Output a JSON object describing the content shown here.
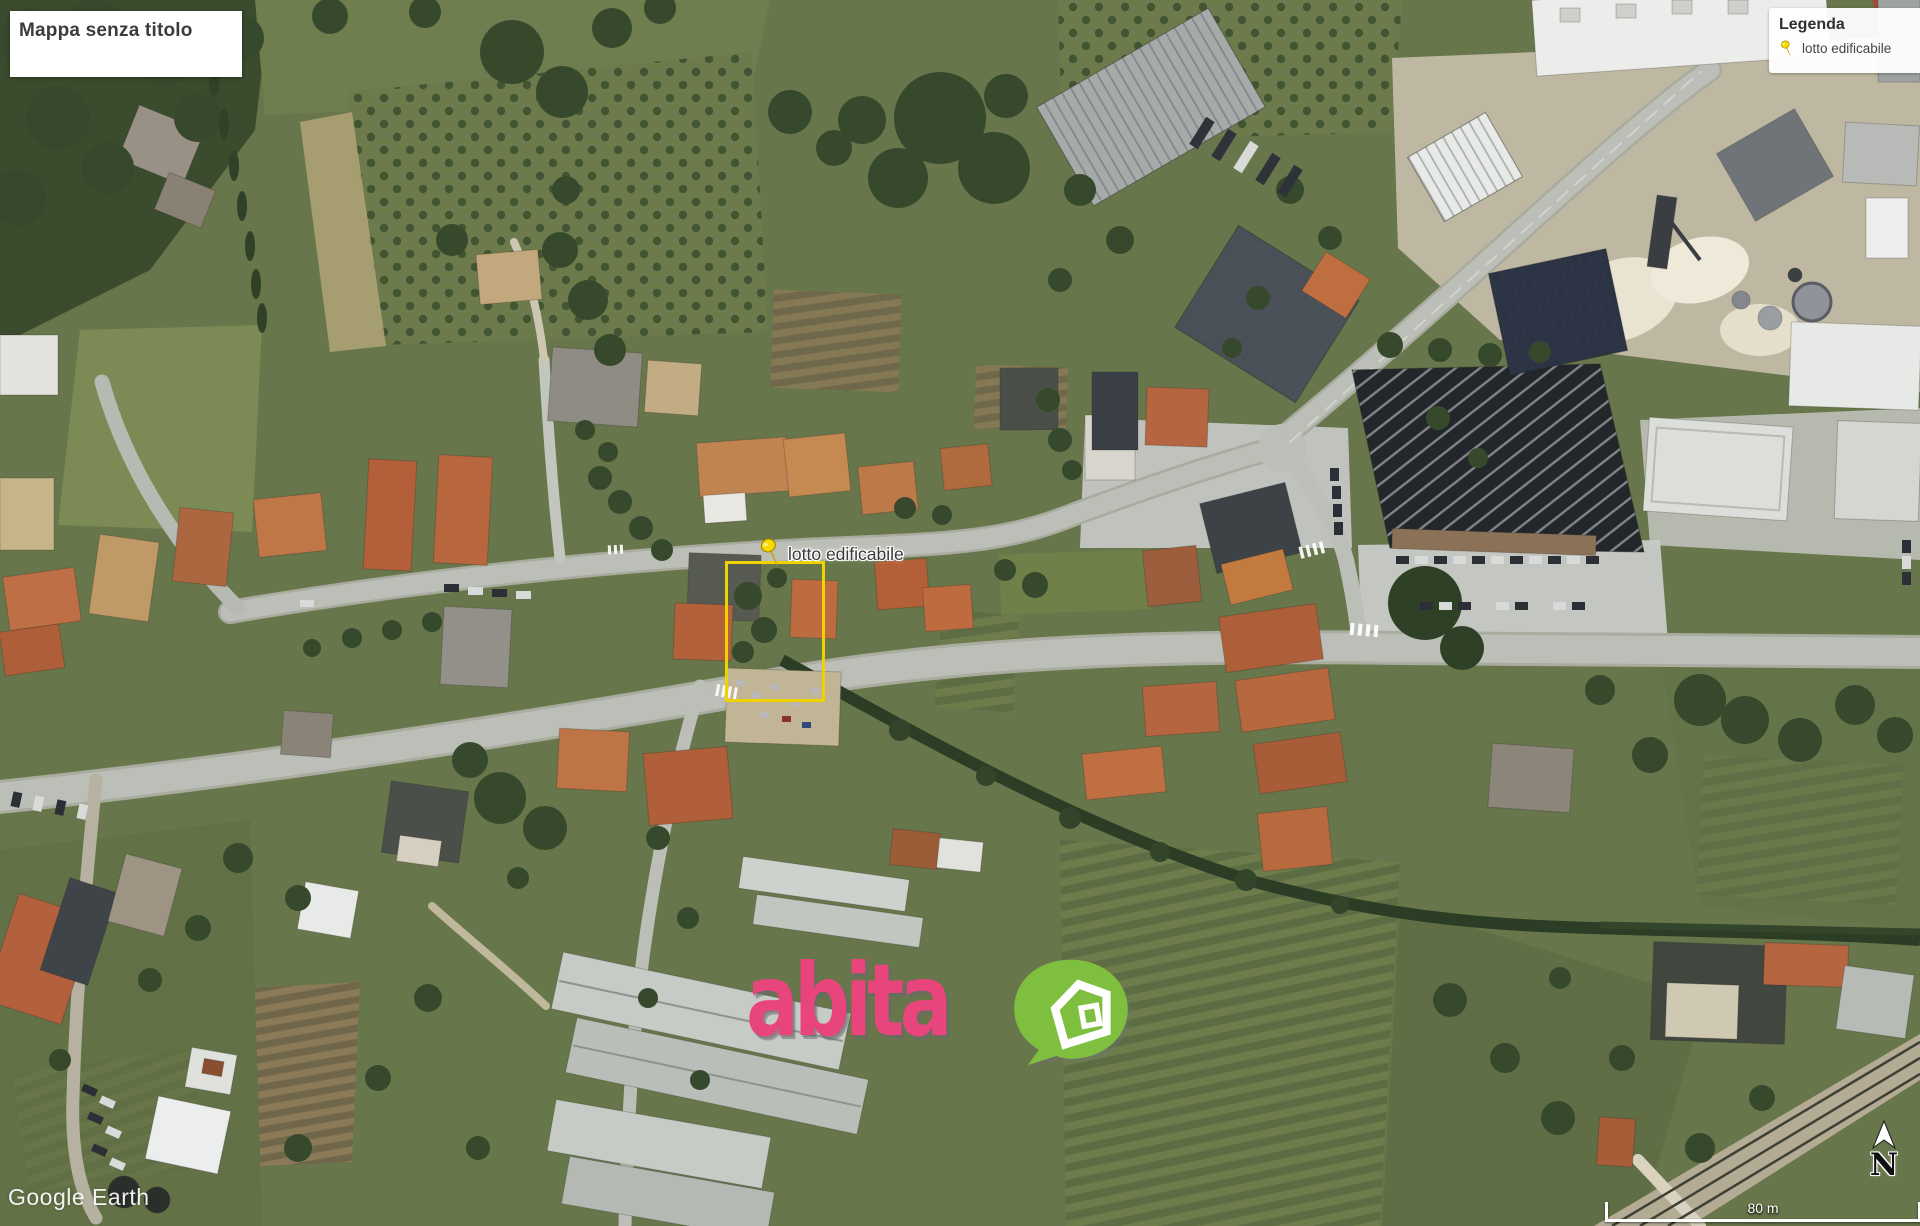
{
  "title_box": {
    "title": "Mappa senza titolo"
  },
  "legend": {
    "title": "Legenda",
    "items": [
      {
        "label": "lotto edificabile",
        "icon": "pushpin-icon",
        "pin_color": "#f7da00"
      }
    ]
  },
  "placemark": {
    "label": "lotto edificabile",
    "pin_color": "#f7da00",
    "plot_outline_color": "#eed201"
  },
  "logo": {
    "text": "abita",
    "text_color": "#e8457c",
    "bubble_color": "#7fbf3f",
    "house_color": "#ffffff"
  },
  "watermark": {
    "text": "Google Earth"
  },
  "compass": {
    "label": "N"
  },
  "scale_bar": {
    "label": "80 m"
  }
}
